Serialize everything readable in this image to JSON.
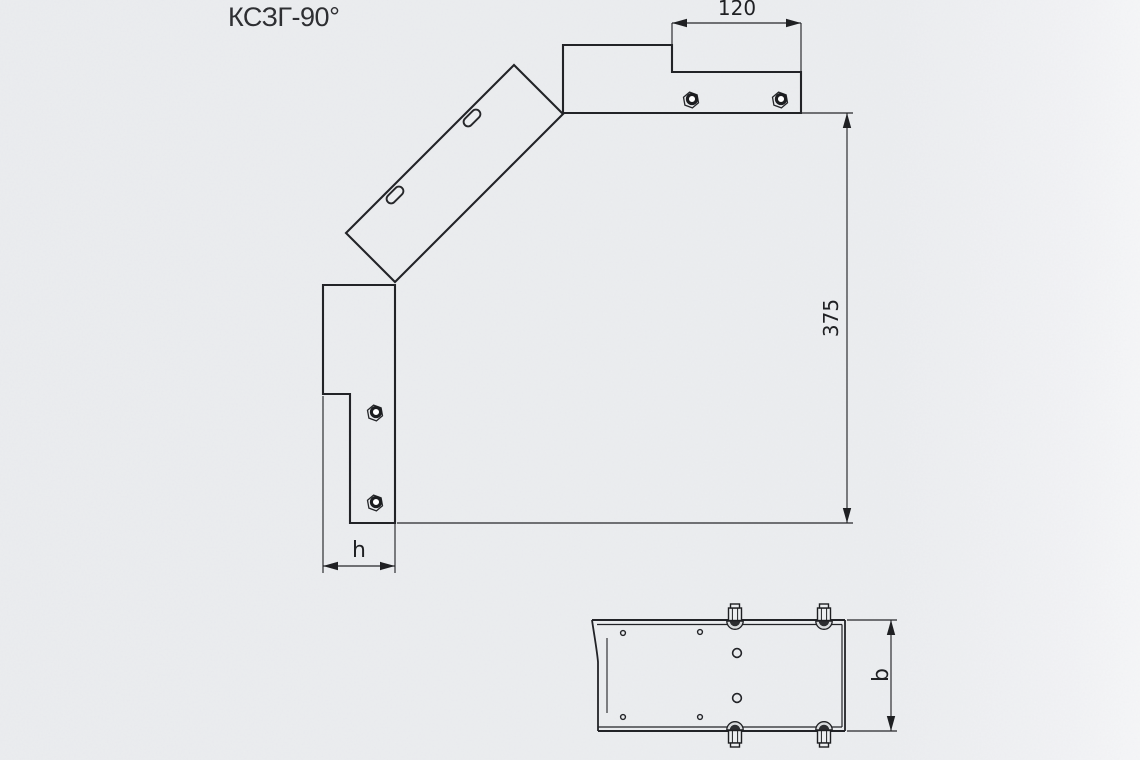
{
  "title": "КСЗГ-90°",
  "front_view": {
    "dim_top_tab_width": "120",
    "dim_height": "375",
    "dim_flange": "h"
  },
  "plan_view": {
    "dim_width": "b"
  },
  "colors": {
    "background": "#eceef0",
    "line": "#202125"
  }
}
